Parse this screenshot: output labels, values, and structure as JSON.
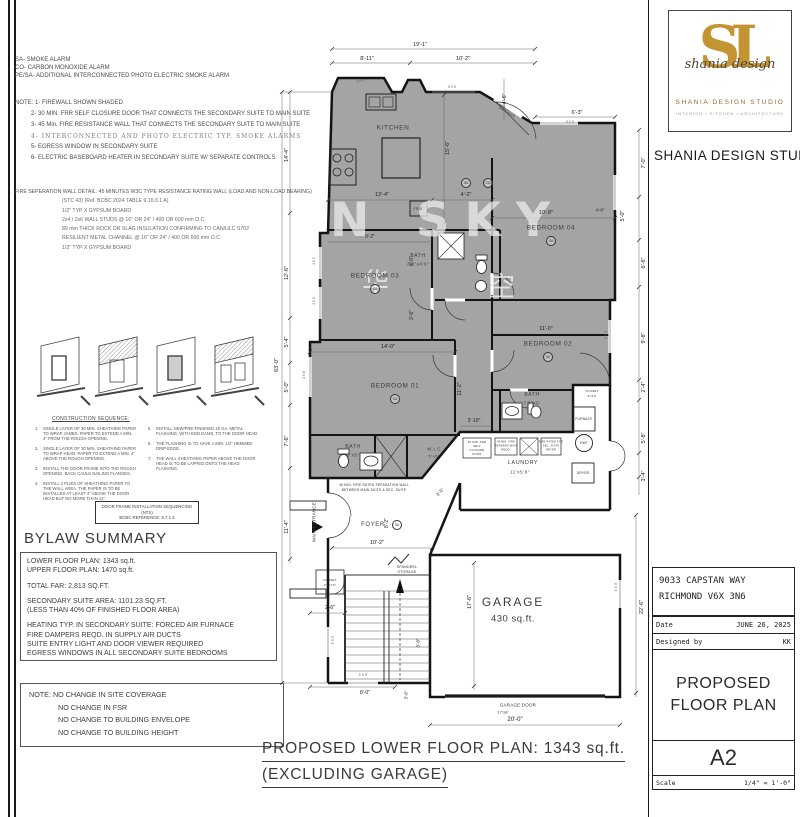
{
  "sheet": {
    "legend": [
      "SA- SMOKE ALARM",
      "CO- CARBON MONOXIDE ALARM",
      "PE/SA- ADDITIONAL  INTERCONNECTED PHOTO ELECTRIC SMOKE ALARM"
    ],
    "notes_title": "NOTE: 1- FIREWALL SHOWN SHADED",
    "notes": [
      "2- 30 MIN. FRR SELF CLOSURE DOOR THAT CONNECTS THE SECONDARY SUITE TO MAIN SUITE",
      "3- 45 Min. FIRE RESISTANCE WALL THAT CONNECTS THE SECONDARY SUITE TO MAIN SUITE",
      "4- INTERCONNECTED AND PHOTO ELECTRIC TYP. SMOKE ALARMS",
      "5- EGRESS WINDOW IN SECONDARY SUITE",
      "6- ELECTRIC BASEBOARD HEATER IN SECONDARY SUITE W/ SEPARATE CONTROLS"
    ],
    "fire_wall_title": "FIRE SEPERATION WALL DETAIL: 45 MINUTES W3C TYPE RESISTANCE RATING WALL (LOAD AND NON-LOAD BEARING)",
    "fire_wall_lines": [
      "(STC 43) (Ref. BCBC 2024 TABLE 9.10.3.1 A)",
      "1/2\" TYP X GYPSUM BOARD",
      "2x4 / 2x6 WALL STUDS @ 16\" OR 24\" / 400 OR 600 mm O.C.",
      "89 mm THICK ROCK OR SLAG INSULATION CONFIRMING TO CAN/ULC S702",
      "RESILIENT METAL CHANNEL @ 16\" OR 24\" / 400 OR 600 mm O.C.",
      "1/2\" TYP X GYPSUM BOARD"
    ],
    "construction_heading": "CONSTRUCTION SEQUENCE:",
    "construction_left": [
      {
        "n": "1.",
        "t": "SINGLE LAYER OF 30 MIN. SHEATHING PAPER TO WRAP JAMBS. PAPER TO EXTEND A MIN. 4\" FROM THE ROUGH OPENING."
      },
      {
        "n": "2.",
        "t": "SINGLE LAYER OF 30 MIN. SHEATHING PAPER TO WRAP HEAD. PAPER TO EXTEND A MIN. 4\" ABOVE THE ROUGH OPENING."
      },
      {
        "n": "3.",
        "t": "INSTALL THE DOOR FRAME INTO THE ROUGH OPENING. BACK CAULK NAILING FLANGES."
      },
      {
        "n": "4.",
        "t": "INSTALL 2 PLIES OF SHEATHING PAPER TO THE WALL AREA. THE PAPER IS TO BE INSTALLED AT LEAST 4\" ABOVE THE DOOR HEAD BUT NO MORE THAN 12\"."
      }
    ],
    "construction_right": [
      {
        "n": "5.",
        "t": "INSTALL NEW/PRE-FINISHED 26 GA. METAL FLASHING, WITH END DAMS, TO THE DOOR HEAD."
      },
      {
        "n": "6.",
        "t": "THE FLASHING IS TO HAVE A MIN. 1/2\" HEMMED DRIP EDGE."
      },
      {
        "n": "7.",
        "t": "THE WALL SHEATHING PAPER ABOVE THE DOOR HEAD IS TO BE LAPPED ONTO THE HEAD FLASHING."
      }
    ],
    "door_frame_box_line1": "DOOR FRAME INSTALLATION SEQUENCING (NTS)",
    "door_frame_box_line2": "BCBC REFERENCE: 9.7.1.3",
    "bylaw_heading": "BYLAW SUMMARY",
    "bylaw_groups": [
      [
        "LOWER FLOOR PLAN: 1343 sq.ft.",
        "UPPER FLOOR PLAN: 1470 sq.ft."
      ],
      [
        "TOTAL FAR: 2,813 SQ.FT."
      ],
      [
        "SECONDARY SUITE AREA: 1101.23 SQ.FT.",
        "(LESS THAN 40% OF FINISHED FLOOR AREA)"
      ],
      [
        "HEATING TYP. IN SECONDARY SUITE: FORCED AIR FURNACE",
        "FIRE DAMPERS REQD. IN SUPPLY AIR DUCTS",
        "SUITE ENTRY LIGHT AND DOOR VIEWER REQUIRED",
        "EGRESS WINDOWS IN ALL SECONDARY SUITE BEDROOMS"
      ]
    ],
    "site_note_line1": "NOTE: NO CHANGE IN SITE COVERAGE",
    "site_note_rest": [
      "NO CHANGE IN FSR",
      "NO CHANGE TO BUILDING ENVELOPE",
      "NO CHANGE TO BUILDING HEIGHT"
    ],
    "main_title_line1": "PROPOSED LOWER FLOOR PLAN: 1343 sq.ft.",
    "main_title_line2": "(EXCLUDING GARAGE)"
  },
  "plan": {
    "watermark": {
      "text": "N SKY",
      "cn1": "华",
      "cn2": "空"
    },
    "shading_color": "#a4a4a4",
    "labels": [
      {
        "t": "KITCHEN",
        "x": 123,
        "y": 93,
        "c": "room"
      },
      {
        "t": "BEDROOM 03",
        "x": 105,
        "y": 241,
        "c": "room"
      },
      {
        "t": "BEDROOM 01",
        "x": 125,
        "y": 351,
        "c": "room"
      },
      {
        "t": "BEDROOM 04",
        "x": 281,
        "y": 193,
        "c": "room"
      },
      {
        "t": "BEDROOM 02",
        "x": 278,
        "y": 309,
        "c": "room"
      },
      {
        "t": "BATH",
        "x": 148,
        "y": 221,
        "c": "room",
        "fs": 5
      },
      {
        "t": "7'0\"x4'6\"",
        "x": 148,
        "y": 229,
        "c": "room",
        "fs": 4.5
      },
      {
        "t": "BATH",
        "x": 262,
        "y": 360,
        "c": "room",
        "fs": 5
      },
      {
        "t": "7'8\"x5'",
        "x": 262,
        "y": 368,
        "c": "room",
        "fs": 4.5
      },
      {
        "t": "BATH",
        "x": 83,
        "y": 412,
        "c": "room",
        "fs": 5
      },
      {
        "t": "8'x5'",
        "x": 83,
        "y": 420,
        "c": "room",
        "fs": 4.5
      },
      {
        "t": "W.I.C",
        "x": 164,
        "y": 414,
        "c": "room",
        "fs": 4.5
      },
      {
        "t": "5'x6'",
        "x": 164,
        "y": 421,
        "c": "room",
        "fs": 4
      },
      {
        "t": "LAUNDRY",
        "x": 253,
        "y": 428,
        "c": "room",
        "fs": 5.5
      },
      {
        "t": "11'x5'8\"",
        "x": 250,
        "y": 437,
        "c": "room",
        "fs": 4.5
      },
      {
        "t": "FOYER",
        "x": 103,
        "y": 490,
        "c": "room",
        "fs": 6
      },
      {
        "t": "GARAGE",
        "x": 243,
        "y": 567,
        "c": "room-lg"
      },
      {
        "t": "430 sq.ft.",
        "x": 243,
        "y": 584,
        "c": "room-md"
      },
      {
        "t": "GARAGE DOOR",
        "x": 248,
        "y": 670,
        "c": "tiny",
        "fs": 4.5
      },
      {
        "t": "17'x8'",
        "x": 233,
        "y": 677,
        "c": "tiny",
        "fs": 4
      },
      {
        "t": "SPANDREL",
        "x": 137,
        "y": 532,
        "c": "tiny",
        "fs": 3.6
      },
      {
        "t": "STORAGE",
        "x": 137,
        "y": 537,
        "c": "tiny",
        "fs": 3.6
      },
      {
        "t": "FURNACE",
        "x": 314,
        "y": 384,
        "c": "tiny",
        "fs": 3.3
      },
      {
        "t": "HWT",
        "x": 314,
        "y": 408,
        "c": "tiny",
        "fs": 3.2
      },
      {
        "t": "DRYER",
        "x": 313,
        "y": 438,
        "c": "tiny",
        "fs": 3.3
      },
      {
        "t": "CLOSET",
        "x": 322,
        "y": 356,
        "c": "tiny",
        "fs": 3.1
      },
      {
        "t": "2'x10'",
        "x": 322,
        "y": 361,
        "c": "tiny",
        "fs": 3.1
      },
      {
        "t": "CLOSET",
        "x": 60,
        "y": 545,
        "c": "tiny",
        "fs": 3.1
      },
      {
        "t": "2'x2'10\"",
        "x": 60,
        "y": 550,
        "c": "tiny",
        "fs": 3.1
      },
      {
        "t": "FRIG",
        "x": 148,
        "y": 174,
        "c": "tiny",
        "fs": 3.4
      },
      {
        "t": "MAIN ENTRANCE",
        "x": 44,
        "y": 487,
        "r": -90,
        "c": "tiny",
        "fs": 4.5
      },
      {
        "t": "SUITE",
        "x": 231,
        "y": 70,
        "r": 31,
        "c": "tiny",
        "fs": 3
      },
      {
        "t": "ENTRANCE",
        "x": 237,
        "y": 77,
        "r": 31,
        "c": "tiny",
        "fs": 3
      },
      {
        "t": "45 MIN. FIRE RATED SEPARATION WALL",
        "x": 104,
        "y": 450,
        "c": "tiny",
        "fs": 3.3
      },
      {
        "t": "BETWEEN MAIN SUITE & SEC. SUITE",
        "x": 104,
        "y": 455,
        "c": "tiny",
        "fs": 3.3
      },
      {
        "t": "30 MIN. FRR",
        "x": 207,
        "y": 407,
        "c": "tiny",
        "fs": 2.8
      },
      {
        "t": "SELF",
        "x": 207,
        "y": 411,
        "c": "tiny",
        "fs": 2.8
      },
      {
        "t": "CLOSURE",
        "x": 207,
        "y": 415,
        "c": "tiny",
        "fs": 2.8
      },
      {
        "t": "DOOR",
        "x": 207,
        "y": 419,
        "c": "tiny",
        "fs": 2.8
      },
      {
        "t": "45 MIN. FIRE",
        "x": 236,
        "y": 407,
        "c": "tiny",
        "fs": 2.6
      },
      {
        "t": "BETWEEN MAIN",
        "x": 236,
        "y": 411,
        "c": "tiny",
        "fs": 2.6
      },
      {
        "t": "REQD.",
        "x": 236,
        "y": 415,
        "c": "tiny",
        "fs": 2.6
      },
      {
        "t": "FIRE RATED FOR",
        "x": 281,
        "y": 407,
        "c": "tiny",
        "fs": 2.6
      },
      {
        "t": "SEC. SUITE",
        "x": 281,
        "y": 411,
        "c": "tiny",
        "fs": 2.6
      },
      {
        "t": "DRYER",
        "x": 281,
        "y": 415,
        "c": "tiny",
        "fs": 2.6
      },
      {
        "t": "19'-1\"",
        "x": 150,
        "y": 10,
        "c": "dim"
      },
      {
        "t": "8'-11\"",
        "x": 97,
        "y": 24,
        "c": "dim"
      },
      {
        "t": "10'-2\"",
        "x": 193,
        "y": 24,
        "c": "dim"
      },
      {
        "t": "6'-3\"",
        "x": 307,
        "y": 78,
        "c": "dim"
      },
      {
        "t": "4'-6\"",
        "x": 235,
        "y": 64,
        "r": -90,
        "c": "dim"
      },
      {
        "t": "5 X 5",
        "x": 300,
        "y": 87,
        "c": "win"
      },
      {
        "t": "3 X 4",
        "x": 90,
        "y": 46,
        "r": -15,
        "c": "win"
      },
      {
        "t": "5 X 5",
        "x": 182,
        "y": 52,
        "c": "win"
      },
      {
        "t": "63'-0\"",
        "x": 7,
        "y": 330,
        "r": -90,
        "c": "dim"
      },
      {
        "t": "14'-4\"",
        "x": 17,
        "y": 120,
        "r": -90,
        "c": "dim"
      },
      {
        "t": "12'-6\"",
        "x": 17,
        "y": 238,
        "r": -90,
        "c": "dim"
      },
      {
        "t": "5'-4\"",
        "x": 17,
        "y": 307,
        "r": -90,
        "c": "dim"
      },
      {
        "t": "5'-0\"",
        "x": 17,
        "y": 352,
        "r": -90,
        "c": "dim"
      },
      {
        "t": "7'-6\"",
        "x": 17,
        "y": 406,
        "r": -90,
        "c": "dim"
      },
      {
        "t": "11'-4\"",
        "x": 17,
        "y": 492,
        "r": -90,
        "c": "dim"
      },
      {
        "t": "7'-0\"",
        "x": 374,
        "y": 128,
        "r": -90,
        "c": "dim"
      },
      {
        "t": "5'-0\"",
        "x": 353,
        "y": 181,
        "r": -90,
        "c": "dim"
      },
      {
        "t": "4'-8\"",
        "x": 330,
        "y": 175,
        "c": "dim",
        "fs": 4.5
      },
      {
        "t": "6'-6\"",
        "x": 374,
        "y": 228,
        "r": -90,
        "c": "dim"
      },
      {
        "t": "9'-8\"",
        "x": 374,
        "y": 303,
        "r": -90,
        "c": "dim"
      },
      {
        "t": "2'-4\"",
        "x": 374,
        "y": 352,
        "r": -90,
        "c": "dim"
      },
      {
        "t": "5'-8\"",
        "x": 374,
        "y": 403,
        "r": -90,
        "c": "dim"
      },
      {
        "t": "3'-4\"",
        "x": 374,
        "y": 441,
        "r": -90,
        "c": "dim"
      },
      {
        "t": "22'-6\"",
        "x": 372,
        "y": 572,
        "r": -90,
        "c": "dim"
      },
      {
        "t": "5 X 3",
        "x": 336,
        "y": 300,
        "r": -90,
        "c": "win"
      },
      {
        "t": "4' X 3'",
        "x": 346,
        "y": 552,
        "r": -90,
        "c": "win"
      },
      {
        "t": "3' X 5'",
        "x": 63,
        "y": 605,
        "r": -90,
        "c": "win"
      },
      {
        "t": "3' X 5'",
        "x": 93,
        "y": 640,
        "c": "win"
      },
      {
        "t": "4 X 5",
        "x": 44,
        "y": 226,
        "r": -90,
        "c": "win"
      },
      {
        "t": "4 X 6",
        "x": 44,
        "y": 266,
        "r": -90,
        "c": "win"
      },
      {
        "t": "4 X 6",
        "x": 34,
        "y": 340,
        "r": -90,
        "c": "win"
      },
      {
        "t": "15'-6\"",
        "x": 178,
        "y": 113,
        "r": -90,
        "c": "dim"
      },
      {
        "t": "13'-4\"",
        "x": 112,
        "y": 160,
        "c": "dim"
      },
      {
        "t": "4'-2\"",
        "x": 196,
        "y": 160,
        "c": "dim"
      },
      {
        "t": "10'-8\"",
        "x": 276,
        "y": 178,
        "c": "dim"
      },
      {
        "t": "11'-0\"",
        "x": 276,
        "y": 294,
        "c": "dim"
      },
      {
        "t": "9'-2\"",
        "x": 100,
        "y": 202,
        "c": "dim",
        "fs": 5
      },
      {
        "t": "8'-0\"",
        "x": 142,
        "y": 226,
        "r": -90,
        "c": "dim",
        "fs": 5
      },
      {
        "t": "3'-6\"",
        "x": 142,
        "y": 280,
        "r": -90,
        "c": "dim",
        "fs": 5
      },
      {
        "t": "14'-0\"",
        "x": 118,
        "y": 312,
        "c": "dim"
      },
      {
        "t": "11'-2\"",
        "x": 190,
        "y": 354,
        "r": -90,
        "c": "dim"
      },
      {
        "t": "3'-10\"",
        "x": 204,
        "y": 386,
        "c": "dim",
        "fs": 5
      },
      {
        "t": "8'-2\"",
        "x": 117,
        "y": 488,
        "r": -90,
        "c": "dim",
        "fs": 5
      },
      {
        "t": "10'-2\"",
        "x": 107,
        "y": 508,
        "c": "dim"
      },
      {
        "t": "3'-5\"",
        "x": 170,
        "y": 457,
        "r": -48,
        "c": "dim",
        "fs": 4.5
      },
      {
        "t": "2'-6\"",
        "x": 60,
        "y": 573,
        "c": "dim",
        "fs": 5
      },
      {
        "t": "8'-0\"",
        "x": 95,
        "y": 658,
        "c": "dim",
        "fs": 5
      },
      {
        "t": "3'-6\"",
        "x": 136,
        "y": 660,
        "r": -90,
        "c": "dim",
        "fs": 4.5
      },
      {
        "t": "3'-8\"",
        "x": 148,
        "y": 608,
        "r": -90,
        "c": "dim",
        "fs": 4.5
      },
      {
        "t": "17'-6\"",
        "x": 200,
        "y": 567,
        "r": -90,
        "c": "dim"
      },
      {
        "t": "20'-0\"",
        "x": 245,
        "y": 685,
        "c": "dim",
        "fs": 6
      },
      {
        "t": "SA",
        "x": 105,
        "y": 254,
        "c": "sa"
      },
      {
        "t": "SA",
        "x": 125,
        "y": 364,
        "c": "sa"
      },
      {
        "t": "SA",
        "x": 281,
        "y": 206,
        "c": "sa"
      },
      {
        "t": "SA",
        "x": 278,
        "y": 322,
        "c": "sa"
      },
      {
        "t": "SA",
        "x": 127,
        "y": 490,
        "c": "sa"
      },
      {
        "t": "SA",
        "x": 196,
        "y": 148,
        "c": "sa"
      },
      {
        "t": "CO",
        "x": 218,
        "y": 148,
        "c": "sa"
      }
    ]
  },
  "logo": {
    "monogram": "SL",
    "script": "shania design",
    "studio": "SHANIA DESIGN STUDIO",
    "tagline": "INTERIOR  •  KITCHEN  •  ARCHITECTURE",
    "below_text": "SHANIA DESIGN STUDIO",
    "gold": "#c59432"
  },
  "title_block": {
    "address_line1": "9033 CAPSTAN WAY",
    "address_line2": "RICHMOND V6X 3N6",
    "date_label": "Date",
    "date_value": "JUNE 26, 2025",
    "designer_label": "Designed by",
    "designer_value": "KK",
    "sheet_title_line1": "PROPOSED",
    "sheet_title_line2": "FLOOR PLAN",
    "sheet_number": "A2",
    "scale_label": "Scale",
    "scale_value": "1/4\" = 1'-0\""
  }
}
